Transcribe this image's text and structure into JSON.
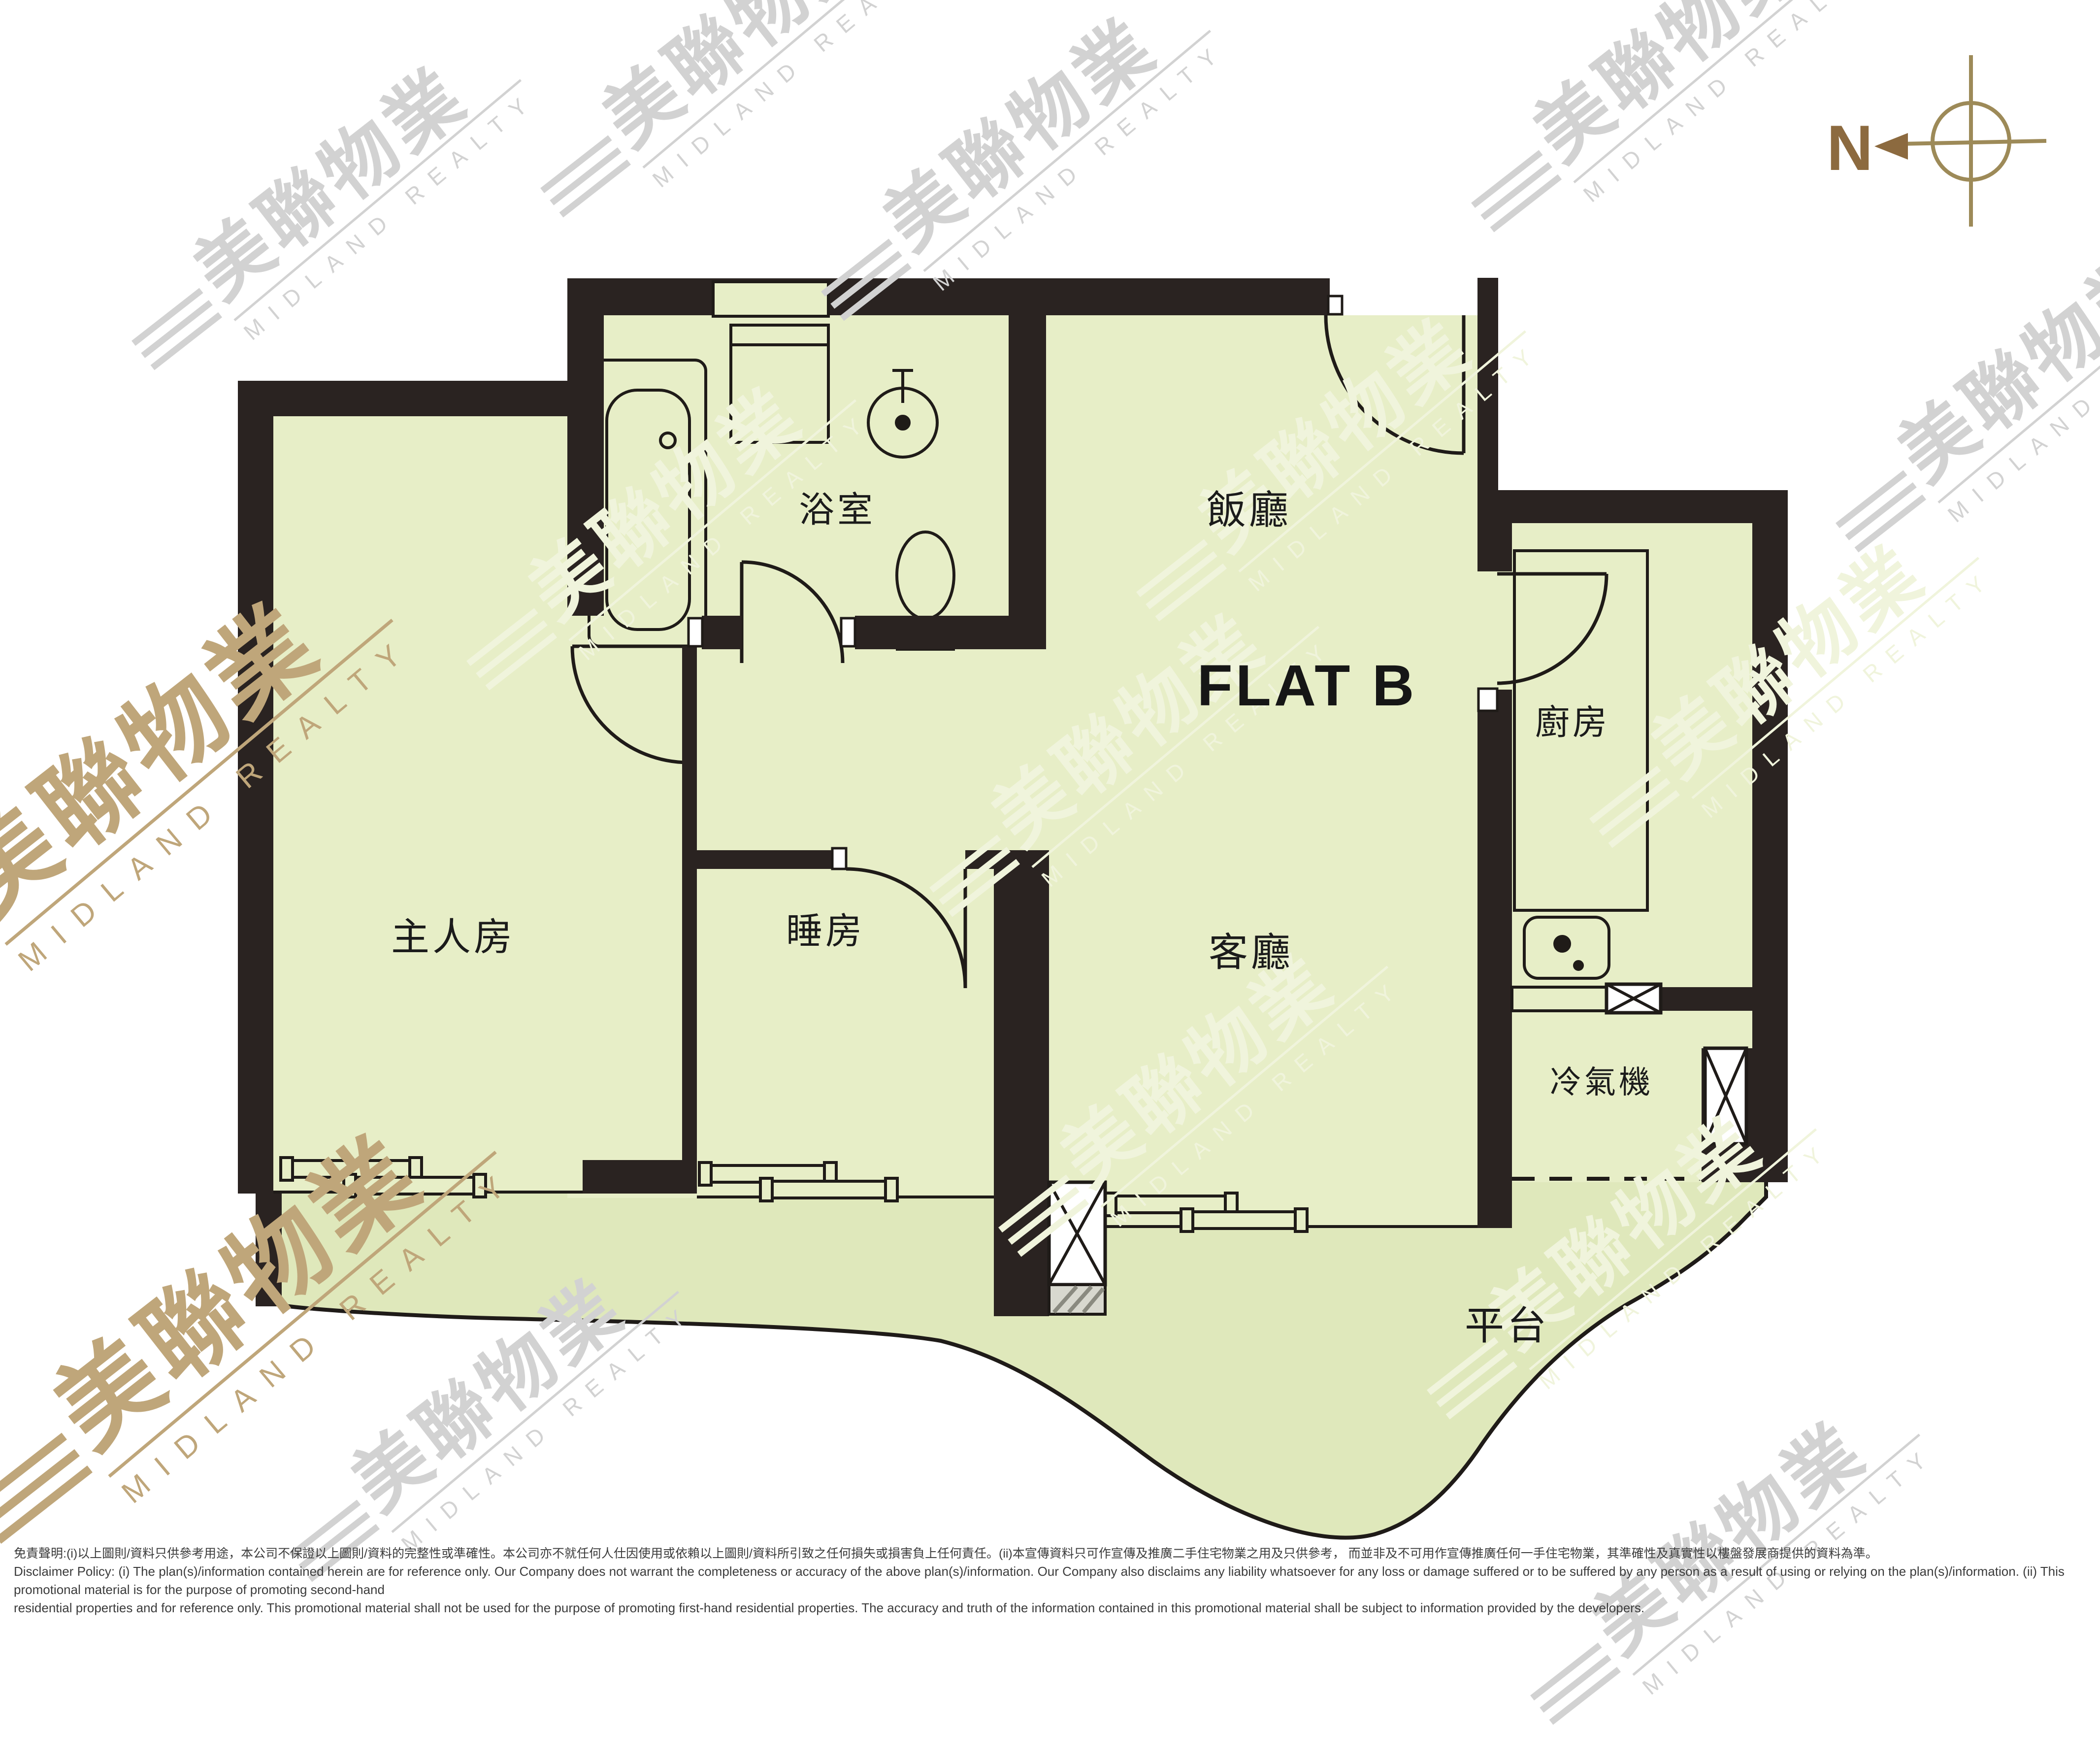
{
  "title": {
    "flat": "FLAT B"
  },
  "plan": {
    "rooms": {
      "master": {
        "label": "主人房"
      },
      "bedroom": {
        "label": "睡房"
      },
      "bathroom": {
        "label": "浴室"
      },
      "dining": {
        "label": "飯廳"
      },
      "kitchen": {
        "label": "廚房"
      },
      "living": {
        "label": "客廳"
      },
      "ac": {
        "label": "冷氣機"
      },
      "terrace": {
        "label": "平台"
      }
    },
    "colors": {
      "wall": "#2a2321",
      "floor": "#e7eec7",
      "terrace": "#dfe8bb",
      "line": "#1f1b18",
      "compass_dark": "#8c6a3f",
      "compass_light": "#9d8a58"
    }
  },
  "compass": {
    "north": "N"
  },
  "watermark": {
    "icon": "≡≡",
    "cjk": "美聯物業",
    "en": "MIDLAND REALTY"
  },
  "disclaimer": {
    "zh": "免責聲明:(i)以上圖則/資料只供參考用途，本公司不保證以上圖則/資料的完整性或準確性。本公司亦不就任何人仕因使用或依賴以上圖則/資料所引致之任何損失或損害負上任何責任。(ii)本宣傳資料只可作宣傳及推廣二手住宅物業之用及只供參考， 而並非及不可用作宣傳推廣任何一手住宅物業，其準確性及真實性以樓盤發展商提供的資料為準。",
    "en1": "Disclaimer Policy: (i) The plan(s)/information contained herein are for reference only. Our Company does not warrant the completeness or accuracy of the above plan(s)/information. Our Company also disclaims any liability whatsoever for any loss or damage suffered or to be suffered by any person as a result of using or relying on the plan(s)/information. (ii) This promotional material is for the purpose of promoting second-hand",
    "en2": "residential properties and for reference only. This promotional material shall not be used for the purpose of promoting first-hand residential properties. The accuracy and truth of the information contained in this promotional material shall be subject to information provided by the developers."
  }
}
